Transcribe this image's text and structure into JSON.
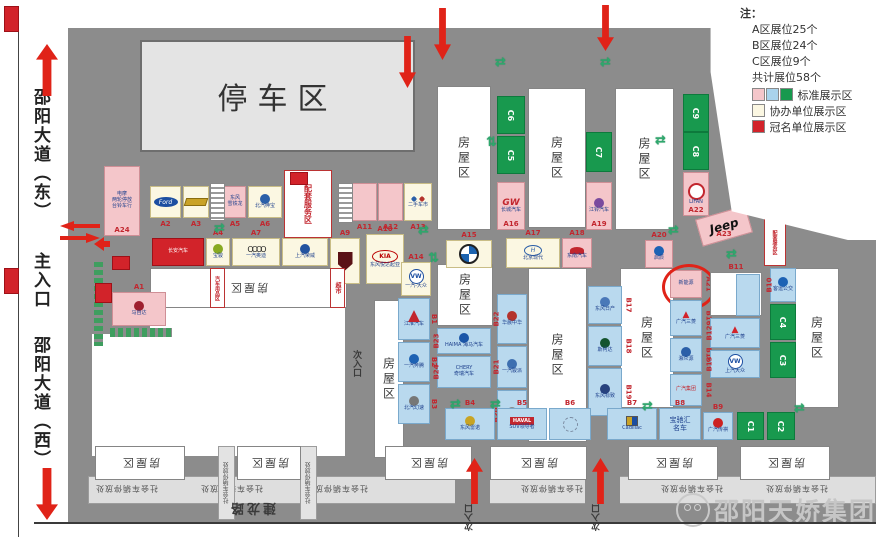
{
  "sidebar": {
    "road_east": "邵阳大道（东）",
    "main_entrance": "主入口",
    "road_west": "邵阳大道（西）"
  },
  "legend": {
    "note": "注：",
    "items": [
      "A区展位25个",
      "B区展位24个",
      "C区展位9个",
      "共计展位58个"
    ],
    "swatch_rows": [
      {
        "colors": [
          "#f4c6ca",
          "#a9d3ec",
          "#18994e"
        ],
        "label": "标准展示区"
      },
      {
        "colors": [
          "#fbf7e2"
        ],
        "label": "协办单位展示区"
      },
      {
        "colors": [
          "#d2232a"
        ],
        "label": "冠名单位展示区"
      }
    ]
  },
  "parking_label": "停车区",
  "watermark": "邵阳天娇集团",
  "street_name": "建龙路",
  "secondary_entrance_label": "次入口",
  "public_parking_label": "社会车辆停放处",
  "house_label": "房屋区",
  "colors": {
    "pink": "#f4c6ca",
    "cream": "#fbf7e2",
    "blue": "#b9d9ee",
    "green": "#18994e",
    "red": "#d2232a",
    "white": "#ffffff"
  },
  "map": {
    "houses": [
      {
        "x": 437,
        "y": 86,
        "w": 52,
        "h": 142,
        "mode": "v"
      },
      {
        "x": 528,
        "y": 88,
        "w": 56,
        "h": 138,
        "mode": "v"
      },
      {
        "x": 615,
        "y": 88,
        "w": 57,
        "h": 140,
        "mode": "v"
      },
      {
        "x": 437,
        "y": 264,
        "w": 54,
        "h": 60,
        "mode": "v"
      },
      {
        "x": 528,
        "y": 268,
        "w": 57,
        "h": 172,
        "mode": "v"
      },
      {
        "x": 620,
        "y": 268,
        "w": 52,
        "h": 138,
        "mode": "v"
      },
      {
        "x": 795,
        "y": 268,
        "w": 42,
        "h": 138,
        "mode": "v"
      },
      {
        "x": 150,
        "y": 268,
        "w": 195,
        "h": 38,
        "mode": "f"
      },
      {
        "x": 374,
        "y": 300,
        "w": 28,
        "h": 156,
        "mode": "v"
      },
      {
        "x": 95,
        "y": 446,
        "w": 88,
        "h": 32,
        "mode": "f"
      },
      {
        "x": 237,
        "y": 446,
        "w": 62,
        "h": 32,
        "mode": "f"
      },
      {
        "x": 385,
        "y": 446,
        "w": 85,
        "h": 32,
        "mode": "f"
      },
      {
        "x": 490,
        "y": 446,
        "w": 95,
        "h": 32,
        "mode": "f"
      },
      {
        "x": 628,
        "y": 446,
        "w": 88,
        "h": 32,
        "mode": "f"
      },
      {
        "x": 740,
        "y": 446,
        "w": 88,
        "h": 32,
        "mode": "f"
      }
    ],
    "booths": [
      {
        "id": "A24",
        "x": 104,
        "y": 166,
        "w": 36,
        "h": 70,
        "c": "pink",
        "lb": "in",
        "lines": [
          "电摩",
          "两轮停放",
          "台铃车行"
        ]
      },
      {
        "id": "A2",
        "x": 150,
        "y": 186,
        "w": 31,
        "h": 32,
        "c": "cream",
        "lb": "below",
        "logo": "ford"
      },
      {
        "id": "A3",
        "x": 183,
        "y": 186,
        "w": 26,
        "h": 32,
        "c": "cream",
        "lb": "below",
        "logo": "chev"
      },
      {
        "id": "A5",
        "x": 224,
        "y": 186,
        "w": 22,
        "h": 32,
        "c": "pink",
        "lb": "below",
        "lines": [
          "东风",
          "雪铁龙"
        ]
      },
      {
        "id": "A6",
        "x": 248,
        "y": 186,
        "w": 34,
        "h": 32,
        "c": "cream",
        "lb": "below",
        "logo": "circ:#2b5fa8",
        "lines": [
          "北汽绅宝"
        ]
      },
      {
        "id": "A11",
        "x": 352,
        "y": 183,
        "w": 25,
        "h": 38,
        "c": "pink",
        "lb": "below"
      },
      {
        "id": "A12",
        "x": 378,
        "y": 183,
        "w": 25,
        "h": 38,
        "c": "pink",
        "lb": "below"
      },
      {
        "id": "A13",
        "x": 404,
        "y": 183,
        "w": 28,
        "h": 38,
        "c": "cream",
        "lb": "below",
        "logo": "circ2",
        "lines": [
          "二手车市"
        ]
      },
      {
        "id": "",
        "x": 152,
        "y": 238,
        "w": 52,
        "h": 28,
        "c": "red",
        "lb": "none",
        "logo": "vlogo",
        "lines": [
          "长安汽车"
        ],
        "dark": true
      },
      {
        "id": "A4",
        "x": 206,
        "y": 238,
        "w": 24,
        "h": 28,
        "c": "cream",
        "lb": "above",
        "logo": "circ:#8a2",
        "lines": [
          "宝骏"
        ]
      },
      {
        "id": "A7",
        "x": 232,
        "y": 238,
        "w": 48,
        "h": 28,
        "c": "cream",
        "lb": "above",
        "logo": "audi",
        "lines": [
          "一汽奥迪"
        ]
      },
      {
        "id": "A8",
        "x": 282,
        "y": 238,
        "w": 46,
        "h": 28,
        "c": "cream",
        "lb": "above",
        "logo": "circ:#23539f",
        "lines": [
          "上汽荣威"
        ]
      },
      {
        "id": "A9",
        "x": 330,
        "y": 238,
        "w": 30,
        "h": 46,
        "c": "cream",
        "lb": "above",
        "logo": "shield"
      },
      {
        "id": "A10",
        "x": 366,
        "y": 234,
        "w": 38,
        "h": 50,
        "c": "cream",
        "lb": "above",
        "logo": "kia",
        "lines": [
          "东风悦达起亚"
        ]
      },
      {
        "id": "A14",
        "x": 401,
        "y": 262,
        "w": 30,
        "h": 34,
        "c": "cream",
        "lb": "above",
        "logo": "vw",
        "lines": [
          "一汽-大众"
        ]
      },
      {
        "id": "A15",
        "x": 446,
        "y": 240,
        "w": 46,
        "h": 28,
        "c": "cream",
        "lb": "above",
        "logo": "bmw"
      },
      {
        "id": "A16",
        "x": 497,
        "y": 182,
        "w": 28,
        "h": 48,
        "c": "pink",
        "lb": "in",
        "logo": "scr",
        "lines": [
          "长城汽车"
        ]
      },
      {
        "id": "A17",
        "x": 506,
        "y": 238,
        "w": 54,
        "h": 30,
        "c": "cream",
        "lb": "above",
        "logo": "hy2",
        "lines": [
          "北京现代"
        ]
      },
      {
        "id": "A18",
        "x": 562,
        "y": 238,
        "w": 30,
        "h": 30,
        "c": "pink",
        "lb": "above",
        "logo": "wing",
        "lines": [
          "东南汽车"
        ]
      },
      {
        "id": "A19",
        "x": 586,
        "y": 182,
        "w": 26,
        "h": 48,
        "c": "pink",
        "lb": "in",
        "logo": "circ:#7a4a9e",
        "lines": [
          "江铃汽车"
        ]
      },
      {
        "id": "A20",
        "x": 645,
        "y": 240,
        "w": 28,
        "h": 28,
        "c": "pink",
        "lb": "above",
        "logo": "circ:#1d62b4",
        "lines": [
          "启辰"
        ]
      },
      {
        "id": "A21",
        "x": 670,
        "y": 270,
        "w": 32,
        "h": 28,
        "c": "pink",
        "lb": "rr",
        "lines": [
          "新能源"
        ],
        "hl": true
      },
      {
        "id": "A22",
        "x": 683,
        "y": 172,
        "w": 26,
        "h": 44,
        "c": "pink",
        "lb": "in",
        "logo": "lifan",
        "lines": [
          "LIFAN"
        ]
      },
      {
        "id": "A23",
        "x": 698,
        "y": 212,
        "w": 52,
        "h": 28,
        "c": "pink",
        "lb": "in",
        "logo": "jeep",
        "rot": -16
      },
      {
        "id": "A1",
        "x": 112,
        "y": 292,
        "w": 54,
        "h": 34,
        "c": "pink",
        "lb": "above",
        "logo": "circ:#9e1f2e",
        "lines": [
          "马自达"
        ]
      },
      {
        "id": "B1",
        "x": 398,
        "y": 298,
        "w": 32,
        "h": 42,
        "c": "blue",
        "lb": "rr",
        "logo": "jac",
        "lines": [
          "江淮汽车"
        ]
      },
      {
        "id": "B2",
        "x": 398,
        "y": 342,
        "w": 32,
        "h": 40,
        "c": "blue",
        "lb": "rr",
        "logo": "circ:#1d62b4",
        "lines": [
          "一汽奔腾"
        ]
      },
      {
        "id": "B3",
        "x": 398,
        "y": 384,
        "w": 32,
        "h": 40,
        "c": "blue",
        "lb": "rr",
        "logo": "circ:#777",
        "lines": [
          "北汽幻速"
        ]
      },
      {
        "id": "B23",
        "x": 437,
        "y": 328,
        "w": 54,
        "h": 26,
        "c": "blue",
        "lb": "lr",
        "logo": "circ:#1a56a8",
        "lines": [
          "HAIMA 海马汽车"
        ]
      },
      {
        "id": "B24",
        "x": 437,
        "y": 356,
        "w": 54,
        "h": 32,
        "c": "blue",
        "lb": "lr",
        "lines": [
          "CHERY",
          "奇瑞汽车"
        ]
      },
      {
        "id": "B22",
        "x": 497,
        "y": 294,
        "w": 30,
        "h": 50,
        "c": "blue",
        "lb": "lr",
        "logo": "circ:#b4332c",
        "lines": [
          "华晨中华"
        ]
      },
      {
        "id": "B21",
        "x": 497,
        "y": 346,
        "w": 30,
        "h": 42,
        "c": "blue",
        "lb": "lr",
        "logo": "circ:#3d6fb0",
        "lines": [
          "一汽骏派"
        ]
      },
      {
        "id": "B20",
        "x": 497,
        "y": 390,
        "w": 30,
        "h": 50,
        "c": "blue",
        "lb": "lr",
        "logo": "circ:#888",
        "lines": [
          "东风风光"
        ]
      },
      {
        "id": "B17",
        "x": 588,
        "y": 286,
        "w": 34,
        "h": 38,
        "c": "blue",
        "lb": "rr",
        "logo": "circ:#4a78b8",
        "lines": [
          "东风日产"
        ]
      },
      {
        "id": "B18",
        "x": 588,
        "y": 326,
        "w": 34,
        "h": 40,
        "c": "blue",
        "lb": "rr",
        "logo": "circ:#14542e",
        "lines": [
          "斯柯达"
        ]
      },
      {
        "id": "B19",
        "x": 588,
        "y": 368,
        "w": 34,
        "h": 48,
        "c": "blue",
        "lb": "rr",
        "logo": "circ:#27427e",
        "lines": [
          "东风标致"
        ]
      },
      {
        "id": "B16",
        "x": 670,
        "y": 300,
        "w": 32,
        "h": 36,
        "c": "blue",
        "lb": "rr",
        "logo": "mitsu",
        "lines": [
          "广汽三菱"
        ]
      },
      {
        "id": "B15",
        "x": 670,
        "y": 338,
        "w": 32,
        "h": 34,
        "c": "blue",
        "lb": "rr",
        "logo": "circ:#2b5fa8",
        "lines": [
          "湘众源"
        ]
      },
      {
        "id": "B14",
        "x": 670,
        "y": 374,
        "w": 32,
        "h": 32,
        "c": "blue",
        "lb": "rr",
        "lines": [
          "广汽集团"
        ],
        "redln": true
      },
      {
        "id": "B11",
        "x": 710,
        "y": 272,
        "w": 52,
        "h": 44,
        "c": "white",
        "lb": "above",
        "logo": "cell"
      },
      {
        "id": "B12",
        "x": 710,
        "y": 318,
        "w": 50,
        "h": 30,
        "c": "blue",
        "lb": "lr",
        "logo": "mitsu",
        "lines": [
          "广汽三菱"
        ]
      },
      {
        "id": "B13",
        "x": 710,
        "y": 350,
        "w": 50,
        "h": 28,
        "c": "blue",
        "lb": "lr",
        "logo": "vw",
        "lines": [
          "上汽大众"
        ]
      },
      {
        "id": "B10",
        "x": 770,
        "y": 268,
        "w": 26,
        "h": 34,
        "c": "blue",
        "lb": "lr",
        "logo": "circ:#1d62b4",
        "lines": [
          "客运公交"
        ]
      },
      {
        "id": "B4",
        "x": 445,
        "y": 408,
        "w": 50,
        "h": 32,
        "c": "blue",
        "lb": "above",
        "logo": "circ:#c8a424",
        "lines": [
          "东风雷诺"
        ]
      },
      {
        "id": "B5",
        "x": 497,
        "y": 408,
        "w": 50,
        "h": 32,
        "c": "blue",
        "lb": "above",
        "logo": "haval",
        "lines": [
          "SUV领导者"
        ]
      },
      {
        "id": "B6",
        "x": 549,
        "y": 408,
        "w": 42,
        "h": 32,
        "c": "blue",
        "lb": "above",
        "logo": "sketch"
      },
      {
        "id": "B7",
        "x": 607,
        "y": 408,
        "w": 50,
        "h": 32,
        "c": "blue",
        "lb": "above",
        "logo": "cad",
        "lines": [
          "Cadillac"
        ]
      },
      {
        "id": "B8",
        "x": 659,
        "y": 408,
        "w": 42,
        "h": 32,
        "c": "blue",
        "lb": "above",
        "lines": [
          "宝驰汇",
          "名车"
        ],
        "big": true
      },
      {
        "id": "B9",
        "x": 703,
        "y": 412,
        "w": 30,
        "h": 28,
        "c": "blue",
        "lb": "above",
        "logo": "circ:#c22",
        "lines": [
          "广汽传祺"
        ]
      },
      {
        "id": "C6",
        "x": 497,
        "y": 96,
        "w": 28,
        "h": 38,
        "c": "green",
        "lb": "c"
      },
      {
        "id": "C5",
        "x": 497,
        "y": 136,
        "w": 28,
        "h": 38,
        "c": "green",
        "lb": "c"
      },
      {
        "id": "C7",
        "x": 586,
        "y": 132,
        "w": 26,
        "h": 40,
        "c": "green",
        "lb": "c"
      },
      {
        "id": "C9",
        "x": 683,
        "y": 94,
        "w": 26,
        "h": 38,
        "c": "green",
        "lb": "c"
      },
      {
        "id": "C8",
        "x": 683,
        "y": 132,
        "w": 26,
        "h": 38,
        "c": "green",
        "lb": "c"
      },
      {
        "id": "C4",
        "x": 770,
        "y": 304,
        "w": 26,
        "h": 36,
        "c": "green",
        "lb": "c"
      },
      {
        "id": "C3",
        "x": 770,
        "y": 342,
        "w": 26,
        "h": 36,
        "c": "green",
        "lb": "c"
      },
      {
        "id": "C1",
        "x": 737,
        "y": 412,
        "w": 27,
        "h": 28,
        "c": "green",
        "lb": "c"
      },
      {
        "id": "C2",
        "x": 767,
        "y": 412,
        "w": 28,
        "h": 28,
        "c": "green",
        "lb": "c"
      }
    ],
    "service_booths": [
      {
        "t": "配套服务区",
        "x": 284,
        "y": 170,
        "w": 46,
        "h": 66,
        "fs": 8,
        "cap": true
      },
      {
        "t": "配套服务区",
        "x": 764,
        "y": 218,
        "w": 20,
        "h": 46,
        "fs": 5
      },
      {
        "t": "汽车用品区",
        "x": 210,
        "y": 268,
        "w": 13,
        "h": 38,
        "fs": 5
      },
      {
        "t": "超市",
        "x": 330,
        "y": 268,
        "w": 13,
        "h": 38,
        "fs": 6
      }
    ],
    "texts": [
      {
        "t": "次入口",
        "x": 350,
        "y": 350,
        "mode": "v",
        "fs": 9
      },
      {
        "t": "次入口",
        "x": 816,
        "y": 126,
        "mode": "v180",
        "fs": 11
      },
      {
        "t": "次入口",
        "x": 463,
        "y": 504,
        "mode": "v180",
        "fs": 9
      },
      {
        "t": "次入口",
        "x": 590,
        "y": 504,
        "mode": "v180",
        "fs": 9
      },
      {
        "t": "建龙路",
        "x": 228,
        "y": 500,
        "mode": "h180",
        "fs": 13
      }
    ],
    "strip_texts_x": [
      95,
      200,
      305,
      520,
      660,
      765
    ],
    "green_arrows": [
      {
        "x": 495,
        "y": 56,
        "g": "h"
      },
      {
        "x": 600,
        "y": 56,
        "g": "h"
      },
      {
        "x": 655,
        "y": 134,
        "g": "h"
      },
      {
        "x": 214,
        "y": 222,
        "g": "h"
      },
      {
        "x": 418,
        "y": 224,
        "g": "h"
      },
      {
        "x": 668,
        "y": 224,
        "g": "h"
      },
      {
        "x": 428,
        "y": 252,
        "g": "v"
      },
      {
        "x": 486,
        "y": 136,
        "g": "v"
      },
      {
        "x": 726,
        "y": 248,
        "g": "h"
      },
      {
        "x": 450,
        "y": 398,
        "g": "h"
      },
      {
        "x": 490,
        "y": 398,
        "g": "h"
      },
      {
        "x": 642,
        "y": 400,
        "g": "h"
      },
      {
        "x": 794,
        "y": 402,
        "g": "h"
      }
    ],
    "red_arrows": [
      {
        "x": 36,
        "y": 44,
        "h": 52,
        "dir": "up",
        "big": true
      },
      {
        "x": 36,
        "y": 468,
        "h": 52,
        "dir": "down",
        "big": true
      },
      {
        "x": 399,
        "y": 36,
        "h": 52,
        "dir": "down"
      },
      {
        "x": 434,
        "y": 8,
        "h": 52,
        "dir": "down"
      },
      {
        "x": 597,
        "y": 5,
        "h": 46,
        "dir": "down"
      },
      {
        "x": 823,
        "y": 168,
        "h": 54,
        "dir": "down"
      },
      {
        "x": 466,
        "y": 458,
        "h": 46,
        "dir": "up"
      },
      {
        "x": 592,
        "y": 458,
        "h": 46,
        "dir": "up"
      }
    ],
    "stairs": [
      {
        "x": 210,
        "y": 183,
        "w": 13,
        "h": 36
      },
      {
        "x": 338,
        "y": 183,
        "w": 13,
        "h": 38
      }
    ],
    "redboxes": [
      {
        "x": 4,
        "y": 6,
        "w": 13,
        "h": 24
      },
      {
        "x": 4,
        "y": 268,
        "w": 13,
        "h": 24
      },
      {
        "x": 95,
        "y": 283,
        "w": 15,
        "h": 18
      },
      {
        "x": 112,
        "y": 256,
        "w": 16,
        "h": 12
      }
    ]
  }
}
